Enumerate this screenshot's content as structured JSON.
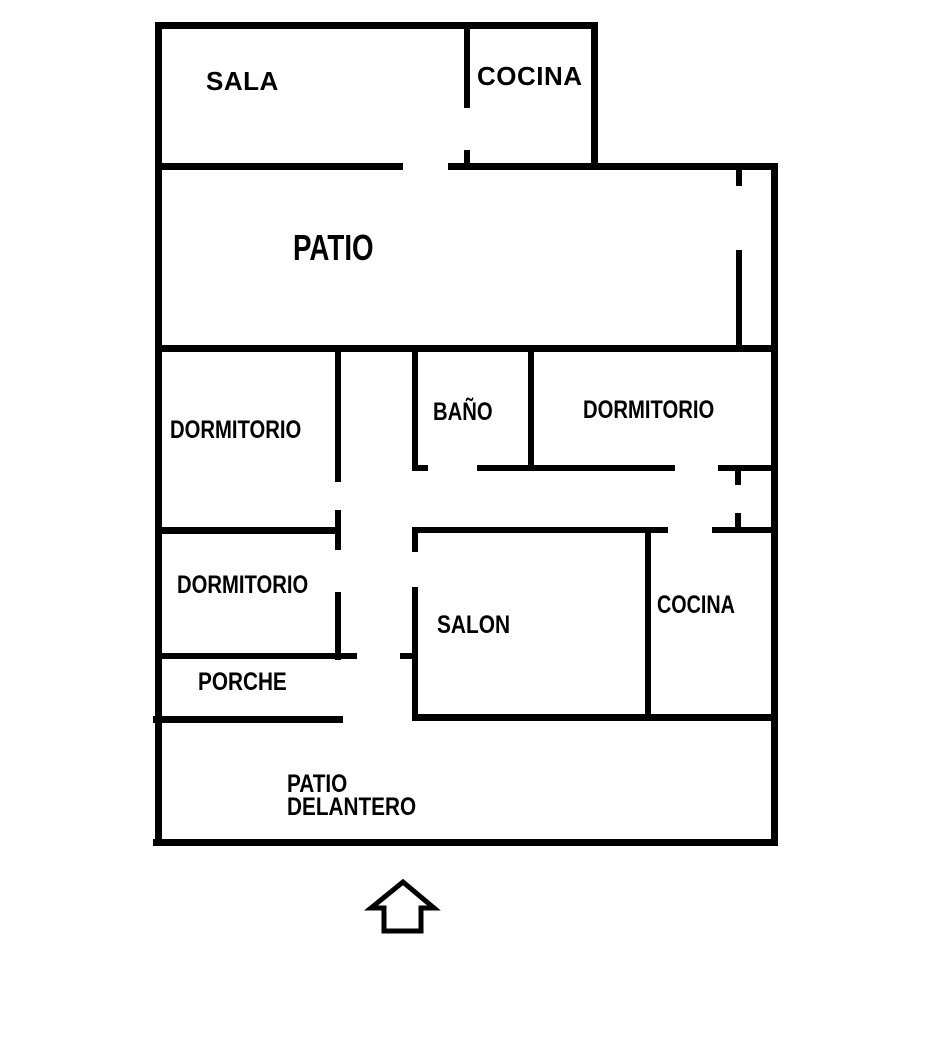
{
  "diagram": {
    "type": "floor-plan",
    "background_color": "#ffffff",
    "wall_color": "#000000",
    "text_color": "#000000",
    "rooms": {
      "sala": {
        "label": "SALA"
      },
      "cocina_top": {
        "label": "COCINA"
      },
      "patio": {
        "label": "PATIO"
      },
      "dormitorio_left_upper": {
        "label": "DORMITORIO"
      },
      "bano": {
        "label": "BAÑO"
      },
      "dormitorio_right": {
        "label": "DORMITORIO"
      },
      "dormitorio_left_lower": {
        "label": "DORMITORIO"
      },
      "salon": {
        "label": "SALON"
      },
      "cocina_lower": {
        "label": "COCINA"
      },
      "porche": {
        "label": "PORCHE"
      },
      "patio_delantero": {
        "label": "PATIO\nDELANTERO"
      }
    },
    "entrance_arrow": {
      "direction": "up"
    }
  }
}
